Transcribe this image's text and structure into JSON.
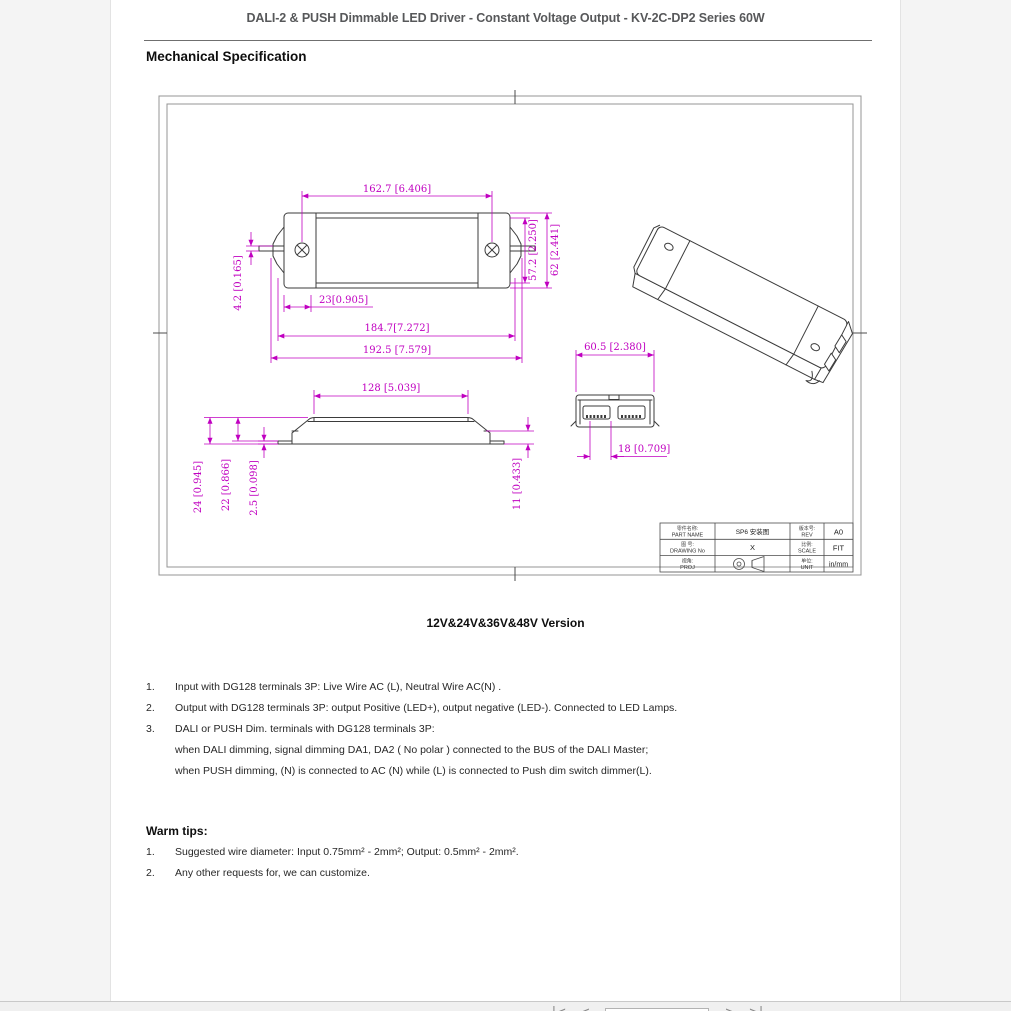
{
  "header": {
    "title": "DALI-2 & PUSH Dimmable LED Driver - Constant Voltage Output - KV-2C-DP2 Series 60W",
    "section_heading": "Mechanical Specification"
  },
  "drawing": {
    "dims": {
      "d_162_7": "162.7 [6.406]",
      "d_57_2": "57.2 [2.250]",
      "d_62": "62 [2.441]",
      "d_4_2": "4.2 [0.165]",
      "d_23": "23[0.905]",
      "d_184_7": "184.7[7.272]",
      "d_192_5": "192.5 [7.579]",
      "d_128": "128 [5.039]",
      "d_24": "24 [0.945]",
      "d_22": "22 [0.866]",
      "d_2_5": "2.5 [0.098]",
      "d_11": "11 [0.433]",
      "d_60_5": "60.5 [2.380]",
      "d_18": "18 [0.709]"
    },
    "title_block": {
      "part_name_cn": "零件名称:",
      "part_name_en": "PART NAME",
      "part_name_value": "SP6 安装图",
      "drawing_no_cn": "图 号:",
      "drawing_no_en": "DRAWING No",
      "drawing_no_value": "X",
      "proj_cn": "视角:",
      "proj_en": "PROJ",
      "rev_cn": "版本号:",
      "rev_en": "REV",
      "rev_value": "A0",
      "scale_cn": "比例:",
      "scale_en": "SCALE",
      "scale_value": "FIT",
      "unit_cn": "单位:",
      "unit_en": "UNIT",
      "unit_value": "in/mm"
    }
  },
  "version_caption": "12V&24V&36V&48V Version",
  "notes": {
    "items": [
      {
        "num": "1.",
        "text": "Input with DG128 terminals 3P: Live Wire AC (L), Neutral Wire AC(N) ."
      },
      {
        "num": "2.",
        "text": "Output with DG128 terminals 3P: output Positive (LED+), output negative (LED-). Connected to LED Lamps."
      },
      {
        "num": "3.",
        "text": "DALI or PUSH Dim. terminals with DG128 terminals 3P:"
      },
      {
        "num": "",
        "text": "when DALI dimming, signal dimming DA1, DA2 ( No polar ) connected to the BUS of the DALI Master;"
      },
      {
        "num": "",
        "text": "when PUSH dimming, (N) is connected to AC (N) while (L) is connected to Push dim switch dimmer(L)."
      }
    ]
  },
  "warm_tips": {
    "heading": "Warm tips:",
    "items": [
      {
        "num": "1.",
        "text": "Suggested wire diameter: Input 0.75mm² - 2mm²; Output: 0.5mm² - 2mm²."
      },
      {
        "num": "2.",
        "text": "Any other requests for, we can customize."
      }
    ]
  },
  "pager": {
    "first": "|<",
    "prev": "<",
    "page_value": "",
    "next": ">",
    "last": ">|"
  },
  "colors": {
    "dimension_magenta": "#c000c0",
    "line_dark": "#3b3b3b",
    "frame_gray": "#949494"
  }
}
